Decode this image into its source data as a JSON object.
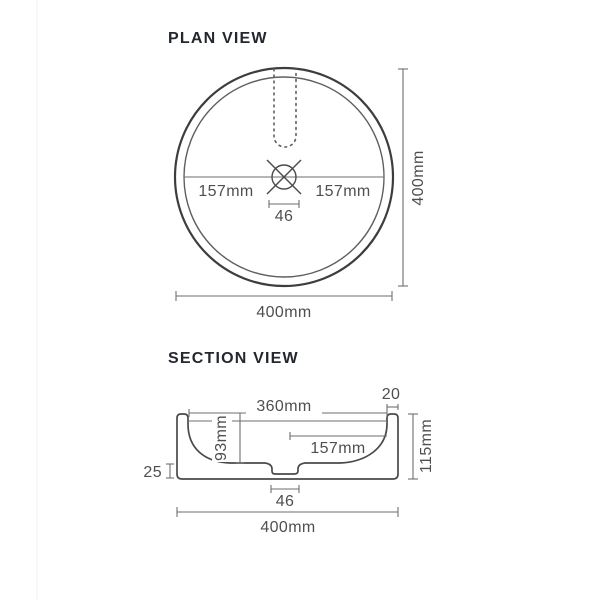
{
  "colors": {
    "outline_dark": "#3d3d3d",
    "shape_line": "#4a4a4a",
    "line": "#5f5f5f",
    "dim_line": "#6e6e6e",
    "dim_text": "#4f4f4f",
    "title_text": "#23272e",
    "background": "#ffffff"
  },
  "plan_view": {
    "title": "PLAN VIEW",
    "dims": {
      "radius_left": "157mm",
      "radius_right": "157mm",
      "drain_width": "46",
      "overall_height": "400mm",
      "overall_width": "400mm"
    }
  },
  "section_view": {
    "title": "SECTION VIEW",
    "dims": {
      "inner_width": "360mm",
      "rim_thickness": "20",
      "bowl_radius": "157mm",
      "bowl_depth": "93mm",
      "overall_height": "115mm",
      "base_height": "25",
      "drain_width": "46",
      "overall_width": "400mm"
    }
  }
}
